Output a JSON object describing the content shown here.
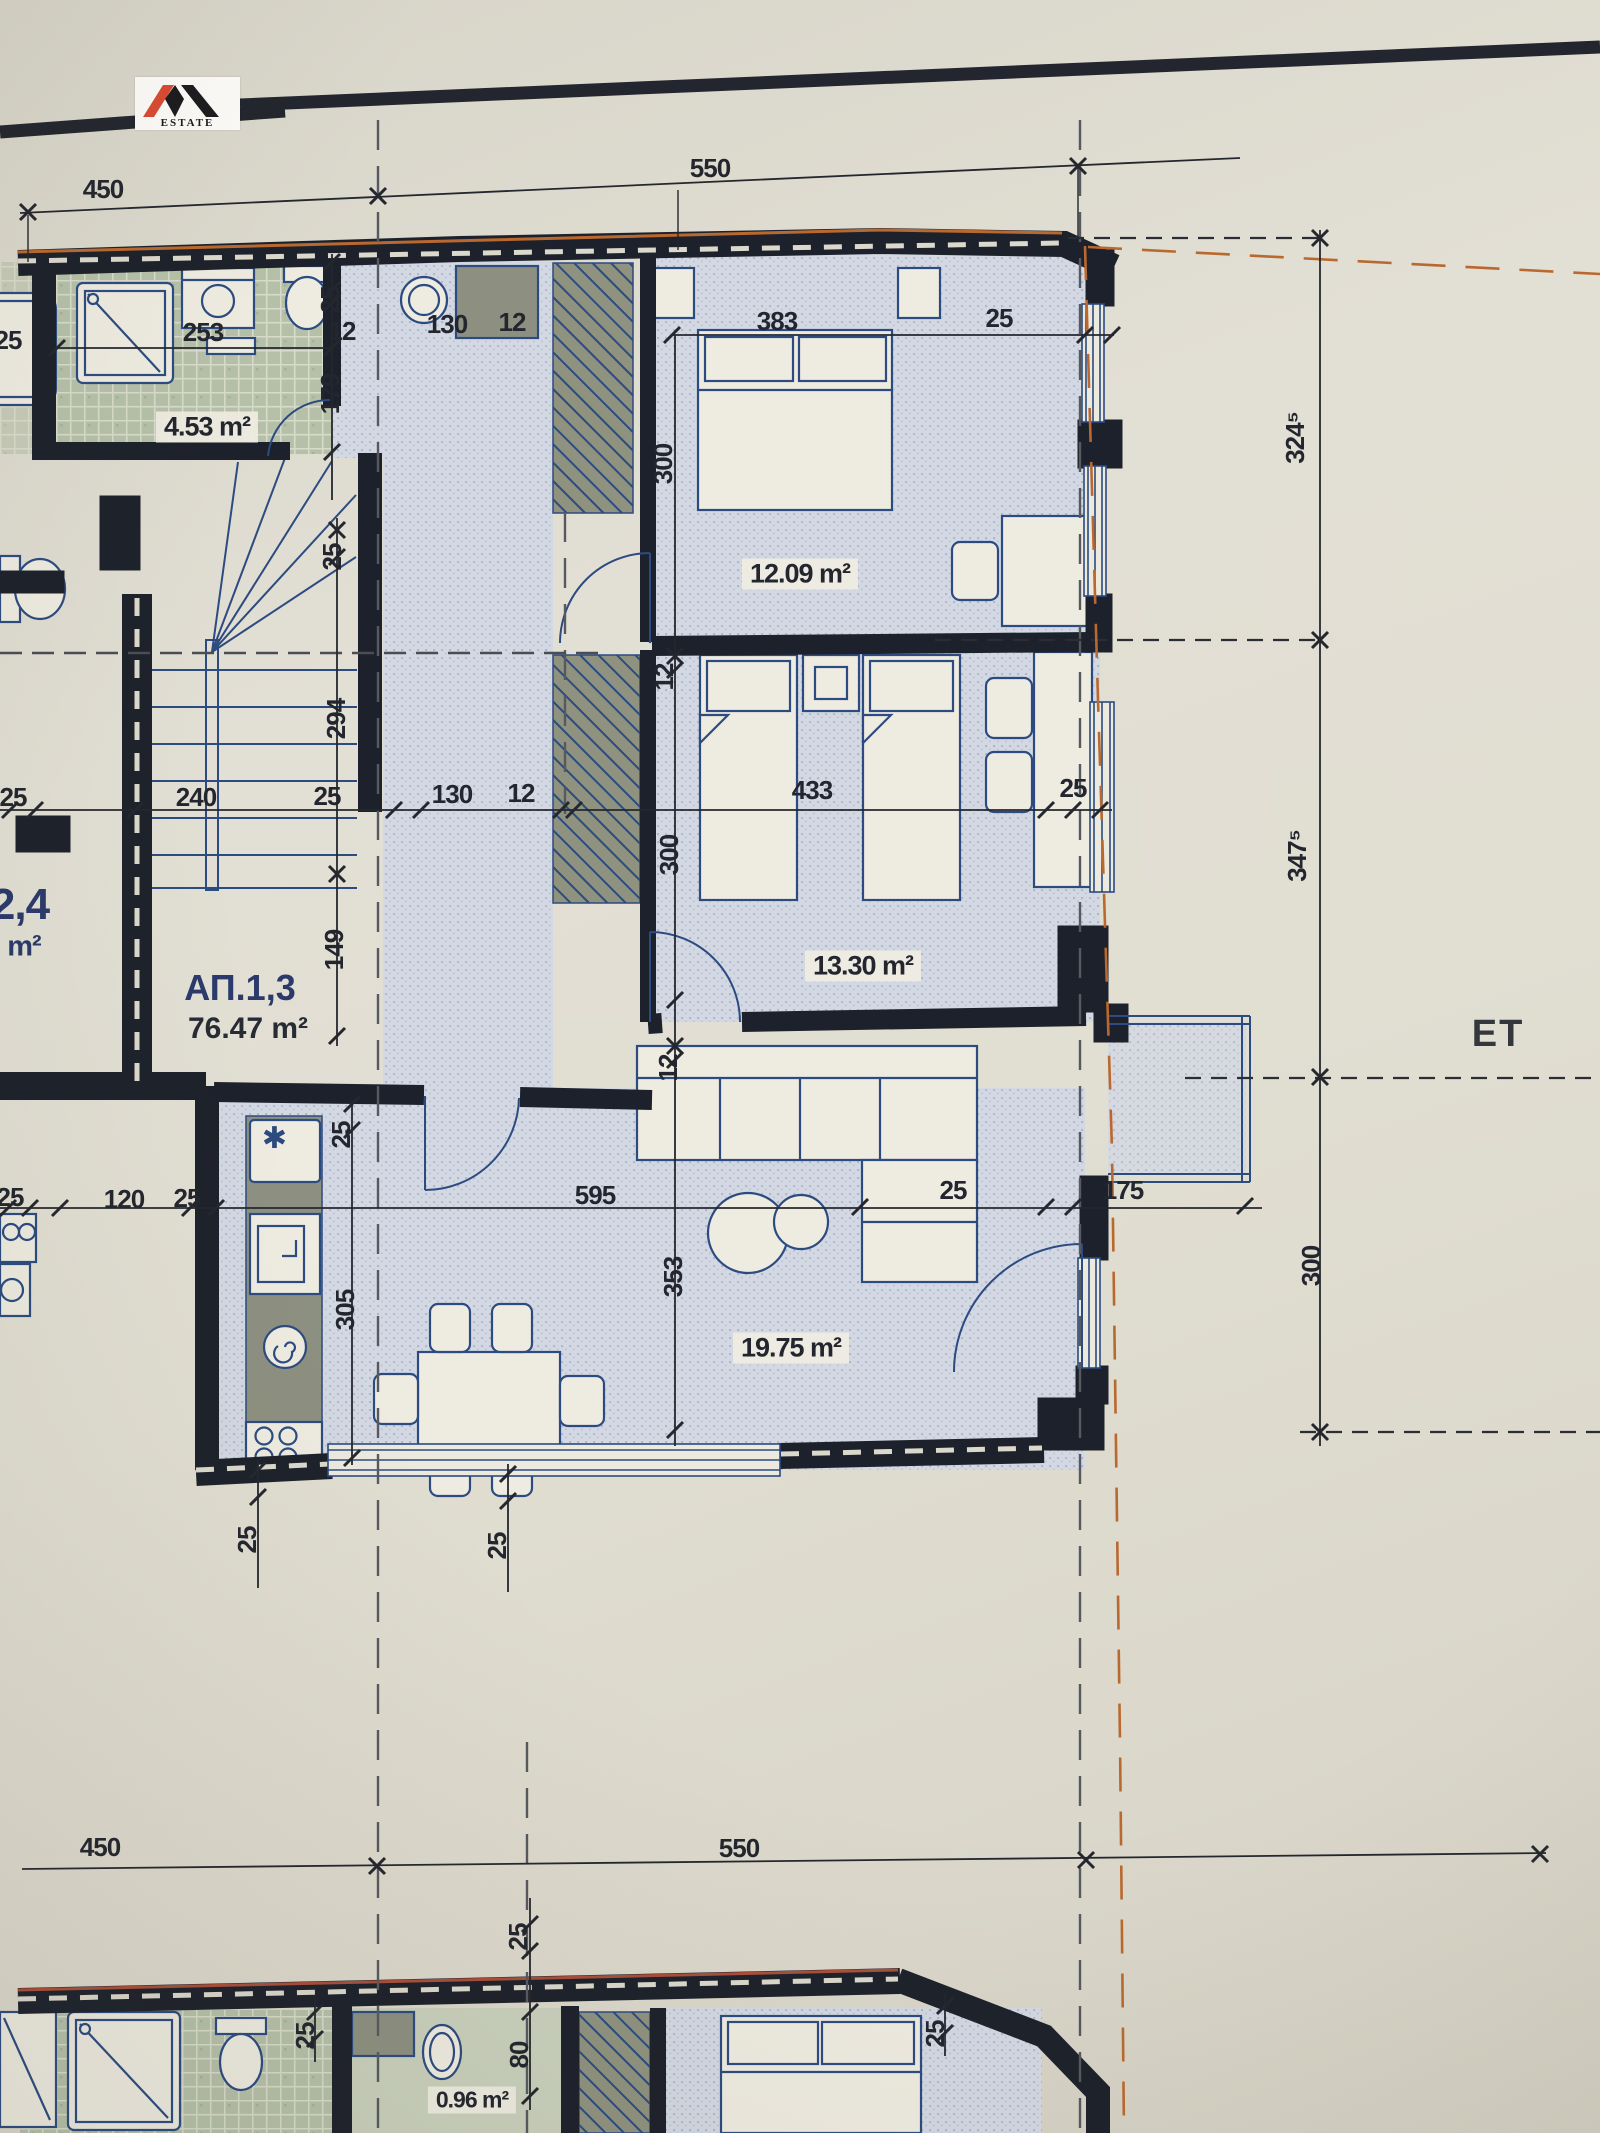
{
  "logo": {
    "estate": "ESTATE"
  },
  "apartment": {
    "id": "АП.1,3",
    "area": "76.47 m²"
  },
  "neighbor_apartment": {
    "id_partial": "2,4",
    "unit": "m²"
  },
  "floor_label_partial": "ЕТ",
  "rooms": [
    {
      "name": "bathroom",
      "area": "4.53 m²"
    },
    {
      "name": "bedroom",
      "area": "12.09 m²"
    },
    {
      "name": "children-bedroom",
      "area": "13.30 m²"
    },
    {
      "name": "living-room-kitchen",
      "area": "19.75 m²"
    },
    {
      "name": "lower-floor-bathroom",
      "area": "0.96 m²"
    }
  ],
  "dimension_chains": {
    "top": [
      "450",
      "550"
    ],
    "bottom": [
      "450",
      "550"
    ],
    "right_side": [
      "324⁵",
      "347⁵",
      "300"
    ],
    "horizontal_mid": [
      "25",
      "240",
      "25",
      "130",
      "12",
      "433",
      "25"
    ],
    "vertical_left": [
      "25",
      "294",
      "149"
    ],
    "vertical_room": [
      "300",
      "12",
      "300",
      "12",
      "353"
    ],
    "bath_top": [
      "253",
      "25",
      "12",
      "130",
      "12",
      "179"
    ],
    "living": [
      "25",
      "120",
      "25",
      "595",
      "25",
      "175",
      "25",
      "305"
    ],
    "lower_plan": [
      "25",
      "80",
      "25",
      "25"
    ]
  },
  "colors": {
    "paper": "#e0ddd2",
    "wall": "#1d212b",
    "furniture_line": "#2c4b80",
    "tile_green": "#b6c0a8",
    "floor_dots": "#d3d8e2",
    "accent_orange": "#b9692f",
    "logo_red": "#d84a32",
    "logo_black": "#1c1c20"
  },
  "labels": [
    {
      "t": "450",
      "x": 103,
      "y": 189
    },
    {
      "t": "550",
      "x": 710,
      "y": 168
    },
    {
      "t": "253",
      "x": 203,
      "y": 332
    },
    {
      "t": "25",
      "x": 330,
      "y": 300,
      "r": 1
    },
    {
      "t": "12",
      "x": 342,
      "y": 331
    },
    {
      "t": "130",
      "x": 447,
      "y": 324
    },
    {
      "t": "12",
      "x": 512,
      "y": 322
    },
    {
      "t": "25",
      "x": 8,
      "y": 340
    },
    {
      "t": "4.53 m²",
      "x": 207,
      "y": 427,
      "k": "a",
      "n": "room-area-label"
    },
    {
      "t": "179",
      "x": 330,
      "y": 394,
      "r": 1
    },
    {
      "t": "383",
      "x": 777,
      "y": 321
    },
    {
      "t": "25",
      "x": 999,
      "y": 318
    },
    {
      "t": "300",
      "x": 663,
      "y": 464,
      "r": 1
    },
    {
      "t": "12.09 m²",
      "x": 800,
      "y": 574,
      "k": "a",
      "n": "room-area-label"
    },
    {
      "t": "324⁵",
      "x": 1295,
      "y": 438,
      "r": 1
    },
    {
      "t": "25",
      "x": 332,
      "y": 557,
      "r": 1
    },
    {
      "t": "294",
      "x": 336,
      "y": 719,
      "r": 1
    },
    {
      "t": "149",
      "x": 334,
      "y": 950,
      "r": 1
    },
    {
      "t": "25",
      "x": 13,
      "y": 797
    },
    {
      "t": "240",
      "x": 196,
      "y": 797
    },
    {
      "t": "25",
      "x": 327,
      "y": 796
    },
    {
      "t": "130",
      "x": 452,
      "y": 794
    },
    {
      "t": "12",
      "x": 521,
      "y": 793
    },
    {
      "t": "433",
      "x": 812,
      "y": 790
    },
    {
      "t": "25",
      "x": 1073,
      "y": 788
    },
    {
      "t": "12",
      "x": 664,
      "y": 677,
      "r": 1
    },
    {
      "t": "300",
      "x": 669,
      "y": 855,
      "r": 1
    },
    {
      "t": "13.30 m²",
      "x": 863,
      "y": 966,
      "k": "a",
      "n": "room-area-label"
    },
    {
      "t": "347⁵",
      "x": 1297,
      "y": 856,
      "r": 1
    },
    {
      "t": "2,4",
      "x": 20,
      "y": 905,
      "k": "n",
      "n": "neighbor-apartment-label"
    },
    {
      "t": "m²",
      "x": 24,
      "y": 947,
      "k": "u",
      "n": "neighbor-apartment-unit"
    },
    {
      "t": "АП.1,3",
      "x": 240,
      "y": 988,
      "k": "i",
      "n": "apartment-id-label"
    },
    {
      "t": "76.47 m²",
      "x": 248,
      "y": 1029,
      "k": "s",
      "n": "apartment-area-label"
    },
    {
      "t": "12",
      "x": 668,
      "y": 1068,
      "r": 1
    },
    {
      "t": "25",
      "x": 10,
      "y": 1197
    },
    {
      "t": "120",
      "x": 124,
      "y": 1199
    },
    {
      "t": "25",
      "x": 187,
      "y": 1198
    },
    {
      "t": "595",
      "x": 595,
      "y": 1195
    },
    {
      "t": "25",
      "x": 953,
      "y": 1190
    },
    {
      "t": "175",
      "x": 1123,
      "y": 1190
    },
    {
      "t": "25",
      "x": 341,
      "y": 1135,
      "r": 1
    },
    {
      "t": "305",
      "x": 345,
      "y": 1310,
      "r": 1
    },
    {
      "t": "353",
      "x": 673,
      "y": 1277,
      "r": 1
    },
    {
      "t": "19.75 m²",
      "x": 791,
      "y": 1348,
      "k": "a",
      "n": "room-area-label"
    },
    {
      "t": "300",
      "x": 1311,
      "y": 1266,
      "r": 1
    },
    {
      "t": "ЕТ",
      "x": 1498,
      "y": 1034,
      "k": "e",
      "n": "floor-label"
    },
    {
      "t": "25",
      "x": 247,
      "y": 1540,
      "r": 1
    },
    {
      "t": "25",
      "x": 497,
      "y": 1546,
      "r": 1
    },
    {
      "t": "450",
      "x": 100,
      "y": 1847
    },
    {
      "t": "550",
      "x": 739,
      "y": 1848
    },
    {
      "t": "25",
      "x": 518,
      "y": 1937,
      "r": 1
    },
    {
      "t": "✱",
      "x": 274,
      "y": 1139,
      "k": "f",
      "n": "fridge-icon"
    },
    {
      "t": "0.96 m²",
      "x": 472,
      "y": 2100,
      "k": "a a2",
      "n": "room-area-label"
    },
    {
      "t": "80",
      "x": 519,
      "y": 2055,
      "r": 1
    },
    {
      "t": "25",
      "x": 305,
      "y": 2036,
      "r": 1
    },
    {
      "t": "25",
      "x": 935,
      "y": 2034,
      "r": 1
    }
  ]
}
